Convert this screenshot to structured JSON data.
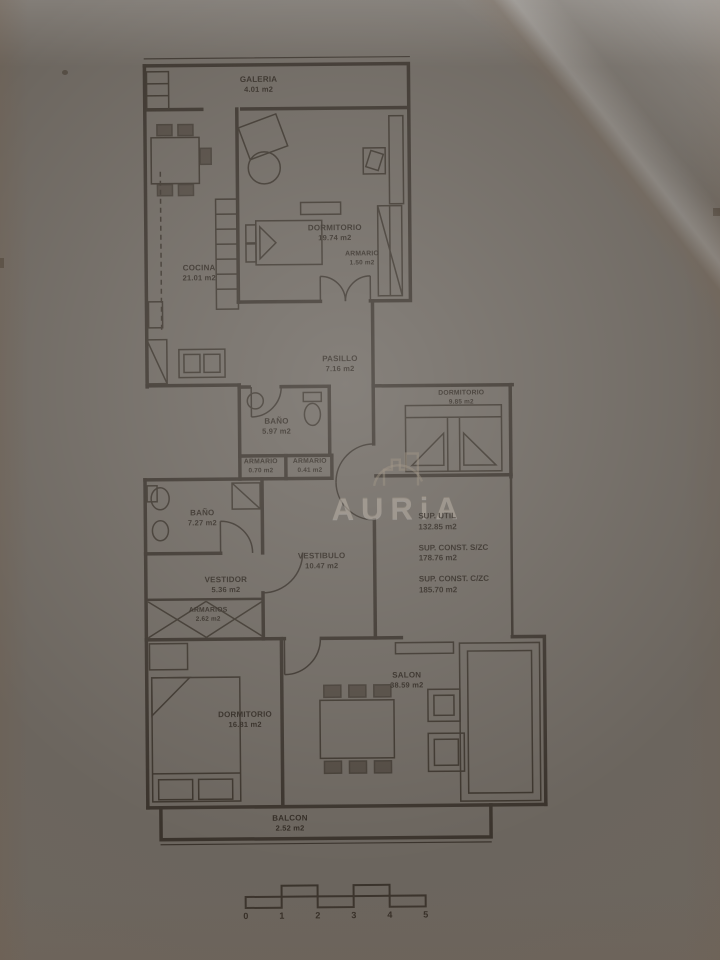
{
  "document": {
    "kind": "apartment floor plan photo"
  },
  "watermark": {
    "brand": "AURiA"
  },
  "rooms": {
    "galeria": {
      "name": "GALERIA",
      "area": "4.01 m2"
    },
    "cocina": {
      "name": "COCINA",
      "area": "21.01 m2"
    },
    "dormitorio1": {
      "name": "DORMITORIO",
      "area": "19.74 m2"
    },
    "armario1": {
      "name": "ARMARIO",
      "area": "1.50 m2"
    },
    "pasillo": {
      "name": "PASILLO",
      "area": "7.16 m2"
    },
    "bano1": {
      "name": "BAÑO",
      "area": "5.97 m2"
    },
    "dormitorio2": {
      "name": "DORMITORIO",
      "area": "9.85 m2"
    },
    "armario2": {
      "name": "ARMARIO",
      "area": "0.70 m2"
    },
    "armario3": {
      "name": "ARMARIO",
      "area": "0.41 m2"
    },
    "bano2": {
      "name": "BAÑO",
      "area": "7.27 m2"
    },
    "vestidor": {
      "name": "VESTIDOR",
      "area": "5.36 m2"
    },
    "armarios": {
      "name": "ARMARIOS",
      "area": "2.62 m2"
    },
    "vestibulo": {
      "name": "VESTIBULO",
      "area": "10.47 m2"
    },
    "dormitorio3": {
      "name": "DORMITORIO",
      "area": "16.81 m2"
    },
    "salon": {
      "name": "SALON",
      "area": "38.59 m2"
    },
    "balcon": {
      "name": "BALCON",
      "area": "2.52 m2"
    }
  },
  "summary": {
    "util_label": "SUP. UTIL",
    "util_value": "132.85 m2",
    "const_label": "SUP. CONST. S/ZC",
    "const_value": "178.76 m2",
    "total_label": "SUP. CONST. C/ZC",
    "total_value": "185.70 m2"
  },
  "scale": {
    "t0": "0",
    "t1": "1",
    "t2": "2",
    "t3": "3",
    "t4": "4",
    "t5": "5"
  },
  "colors": {
    "paper": "#ece3d6",
    "ink": "#38312a",
    "watermark": "#948876"
  }
}
